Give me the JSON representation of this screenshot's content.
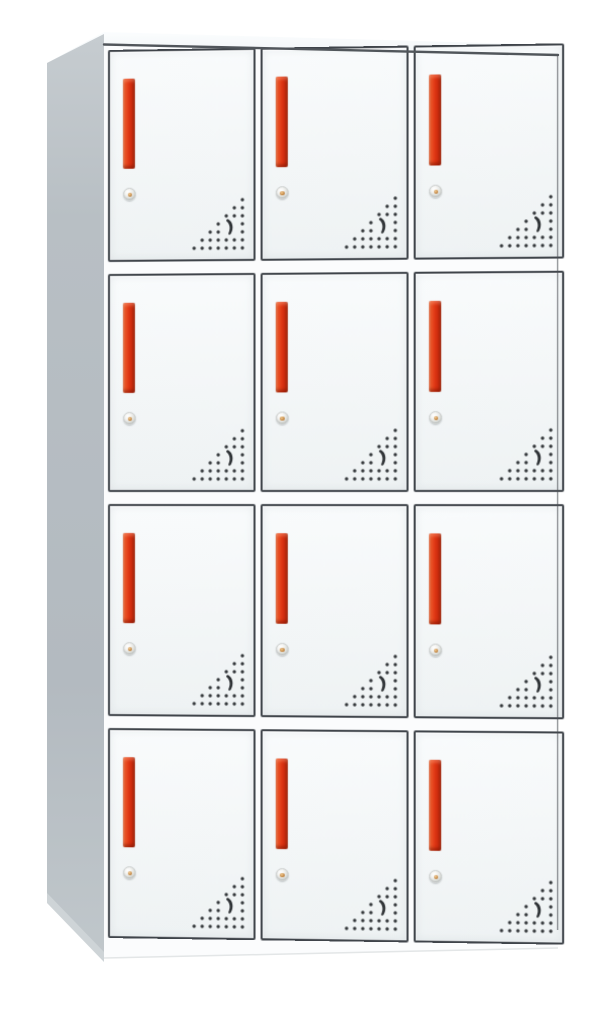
{
  "scene": {
    "description": "Product photo of a white steel locker cabinet with twelve compartments",
    "background": "#ffffff"
  },
  "cabinet": {
    "type": "locker-cabinet",
    "rows": 4,
    "columns": 3,
    "door_count": 12,
    "doors": [
      {
        "id": 1,
        "row": 1,
        "col": 1
      },
      {
        "id": 2,
        "row": 1,
        "col": 2
      },
      {
        "id": 3,
        "row": 1,
        "col": 3
      },
      {
        "id": 4,
        "row": 2,
        "col": 1
      },
      {
        "id": 5,
        "row": 2,
        "col": 2
      },
      {
        "id": 6,
        "row": 2,
        "col": 3
      },
      {
        "id": 7,
        "row": 3,
        "col": 1
      },
      {
        "id": 8,
        "row": 3,
        "col": 2
      },
      {
        "id": 9,
        "row": 3,
        "col": 3
      },
      {
        "id": 10,
        "row": 4,
        "col": 1
      },
      {
        "id": 11,
        "row": 4,
        "col": 2
      },
      {
        "id": 12,
        "row": 4,
        "col": 3
      }
    ],
    "door_features": [
      "vertical-red-handle",
      "cam-lock",
      "triangular-vent-perforation"
    ],
    "vent": {
      "rows": 7,
      "cols": 7,
      "origin": 4,
      "spacing": 8,
      "dot_radius": 1.7,
      "skip": [
        [
          4,
          3
        ],
        [
          5,
          3
        ],
        [
          4,
          4
        ],
        [
          5,
          4
        ]
      ],
      "shape": "right-triangle-bottom-right",
      "center_glyph": "crescent-slot"
    }
  },
  "colors": {
    "background": "#ffffff",
    "door_face": "#f4f7f8",
    "door_border": "#3f444a",
    "handle_red": "#de3513",
    "handle_red_light": "#f08257",
    "handle_red_dark": "#9a1f07",
    "side_panel": "#b6bdc2",
    "top_face": "#f4f6f7",
    "vent_dot": "#34383b",
    "lock_body": "#dddfdb",
    "lock_center": "#b97a35"
  }
}
